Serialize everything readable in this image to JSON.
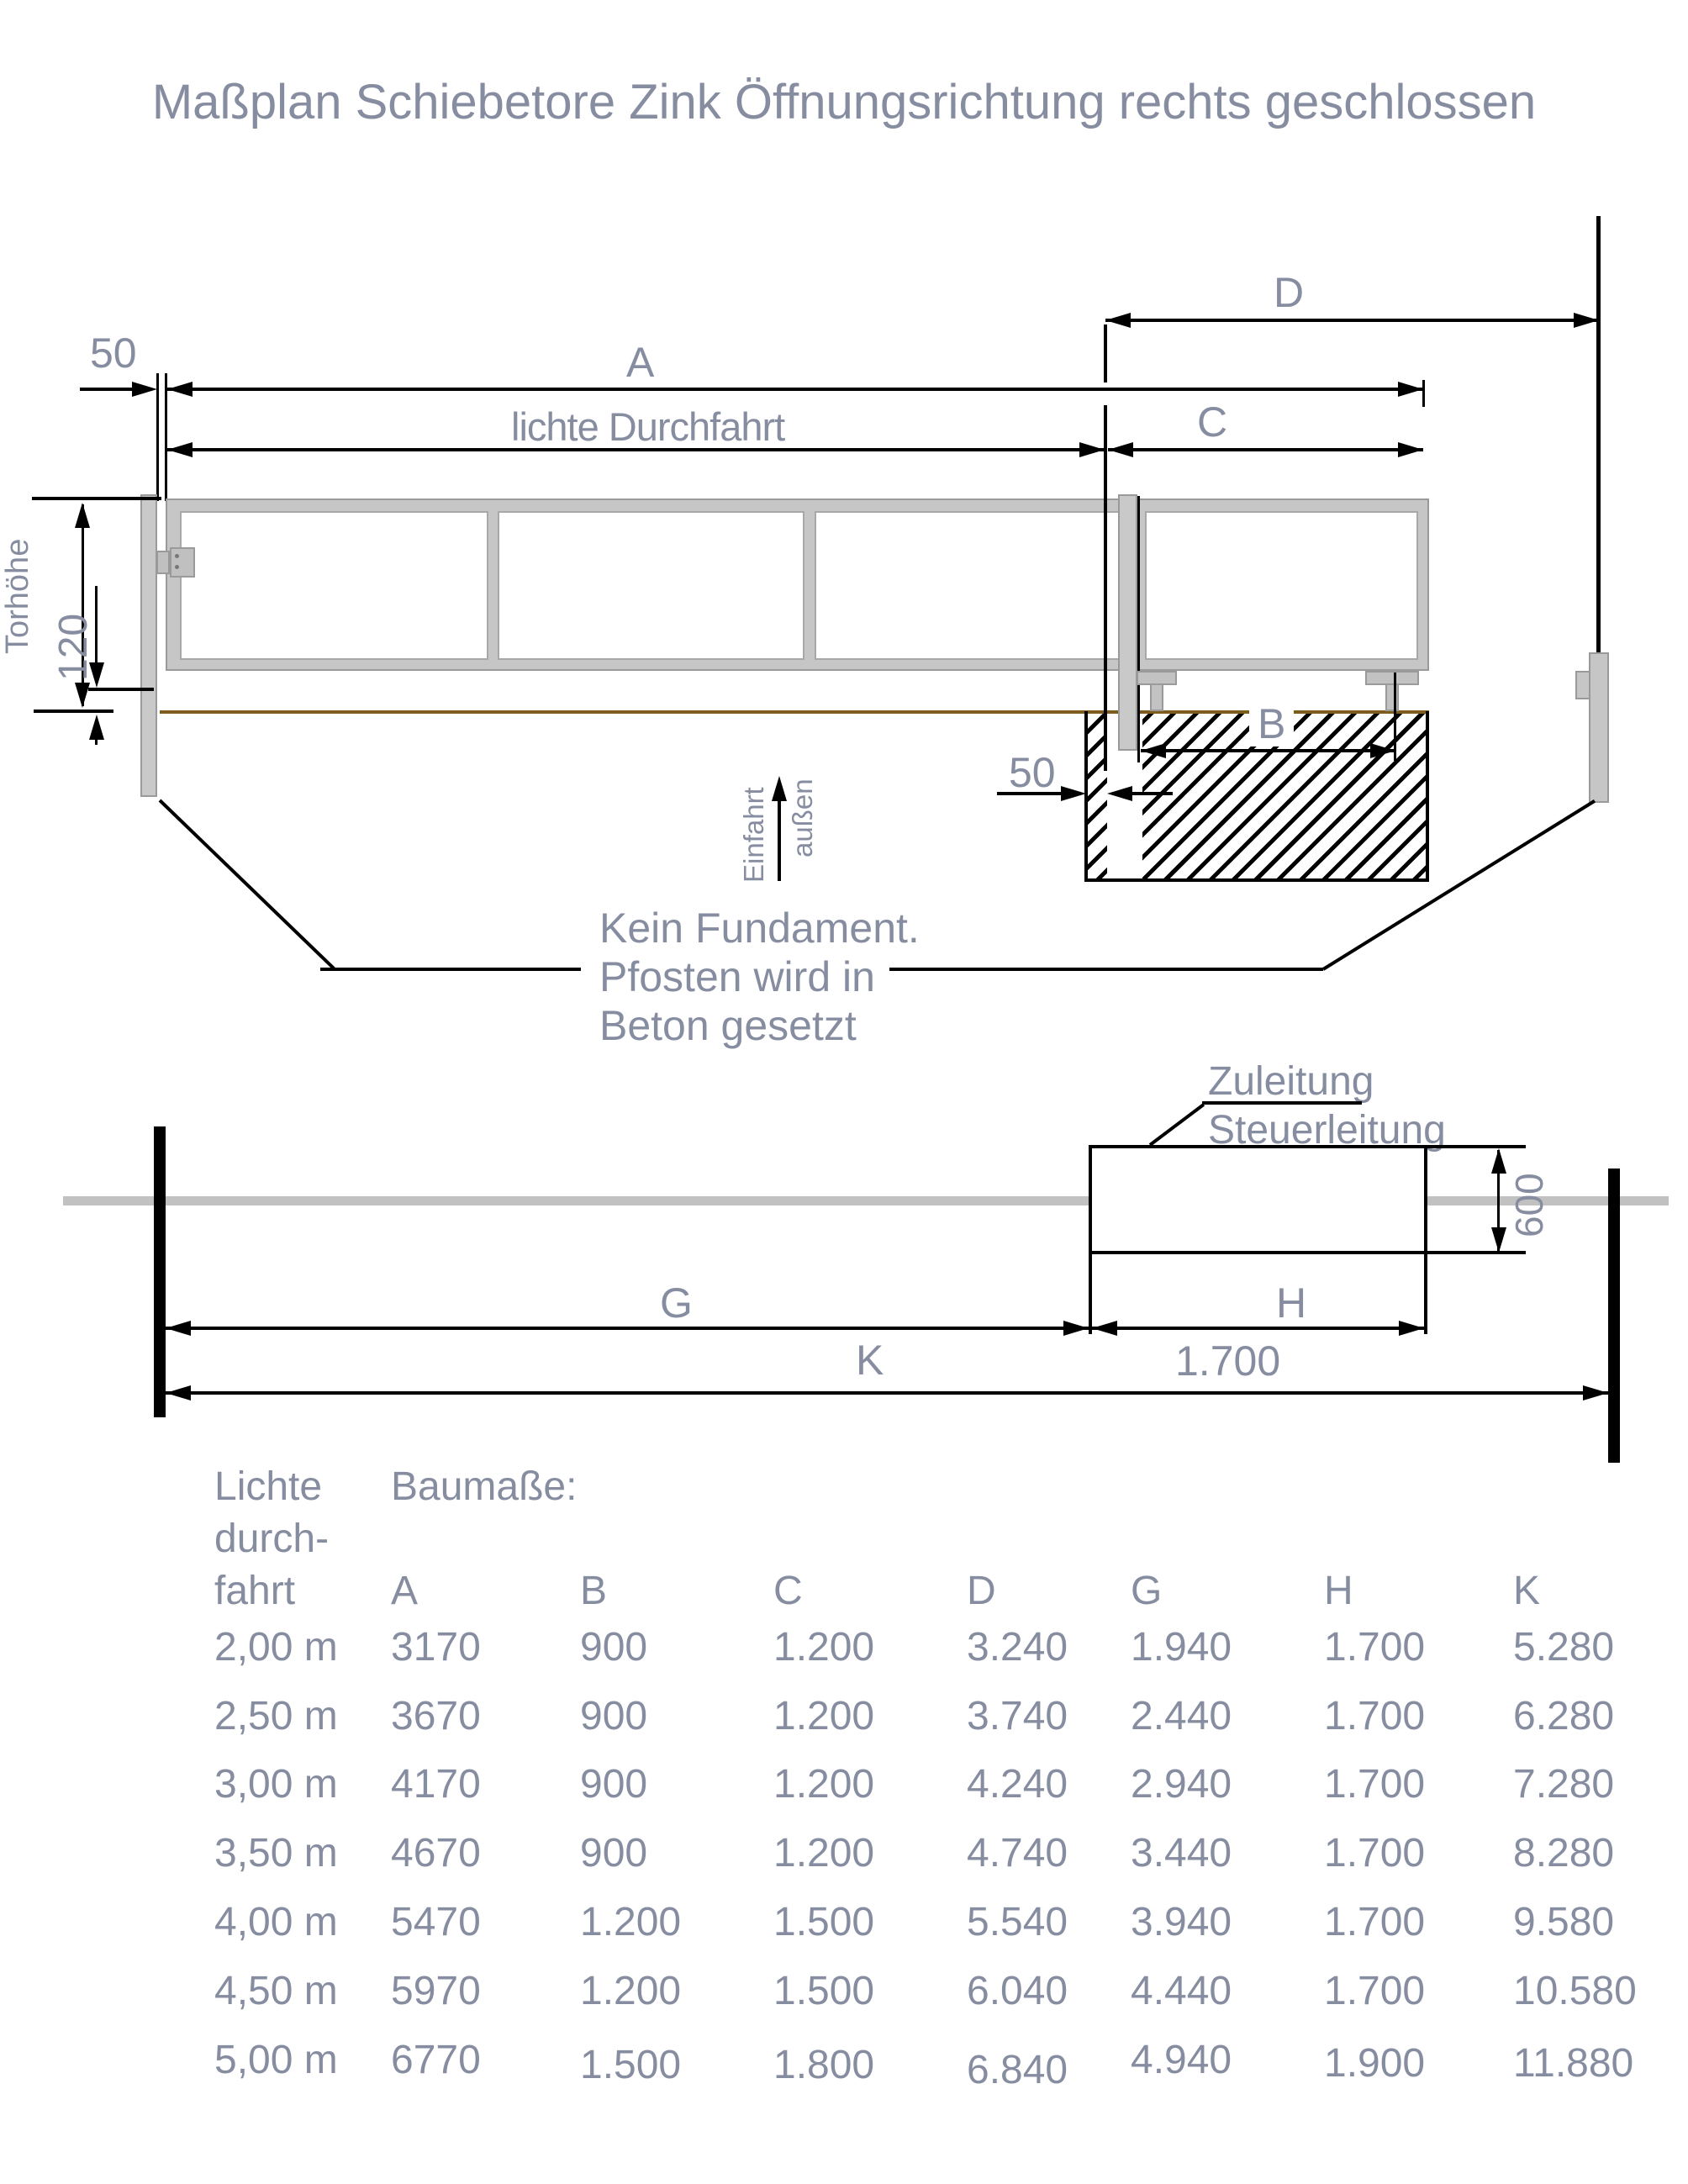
{
  "title": "Maßplan Schiebetore Zink Öffnungsrichtung rechts geschlossen",
  "colors": {
    "label_gray": "#878da0",
    "line_black": "#000000",
    "ground_brown": "#7d5c1d",
    "steel_gray": "#c6c6c6",
    "track_gray": "#c1c1c1"
  },
  "elevation": {
    "dim_50_top": "50",
    "dim_A": "A",
    "dim_lichte": "lichte Durchfahrt",
    "dim_C": "C",
    "dim_D": "D",
    "dim_B": "B",
    "dim_50_foundation": "50",
    "dim_torhoehe": "Torhöhe",
    "dim_120": "120",
    "arrow_einfahrt": "Einfahrt",
    "arrow_aussen": "außen",
    "note_line1": "Kein Fundament.",
    "note_line2": "Pfosten wird in",
    "note_line3": "Beton gesetzt"
  },
  "plan": {
    "callout_line1": "Zuleitung",
    "callout_line2": "Steuerleitung",
    "dim_600": "600",
    "dim_G": "G",
    "dim_H": "H",
    "dim_H_value": "1.700",
    "dim_K": "K"
  },
  "table": {
    "col1_header": [
      "Lichte",
      "durch-",
      "fahrt"
    ],
    "group_header": "Baumaße:",
    "columns": [
      "A",
      "B",
      "C",
      "D",
      "G",
      "H",
      "K"
    ],
    "rows": [
      [
        "2,00 m",
        "3170",
        "900",
        "1.200",
        "3.240",
        "1.940",
        "1.700",
        "5.280"
      ],
      [
        "2,50 m",
        "3670",
        "900",
        "1.200",
        "3.740",
        "2.440",
        "1.700",
        "6.280"
      ],
      [
        "3,00 m",
        "4170",
        "900",
        "1.200",
        "4.240",
        "2.940",
        "1.700",
        "7.280"
      ],
      [
        "3,50 m",
        "4670",
        "900",
        "1.200",
        "4.740",
        "3.440",
        "1.700",
        "8.280"
      ],
      [
        "4,00 m",
        "5470",
        "1.200",
        "1.500",
        "5.540",
        "3.940",
        "1.700",
        "9.580"
      ],
      [
        "4,50 m",
        "5970",
        "1.200",
        "1.500",
        "6.040",
        "4.440",
        "1.700",
        "10.580"
      ],
      [
        "5,00 m",
        "6770",
        "1.500",
        "1.800",
        "6.840",
        "4.940",
        "1.900",
        "11.880"
      ]
    ]
  }
}
